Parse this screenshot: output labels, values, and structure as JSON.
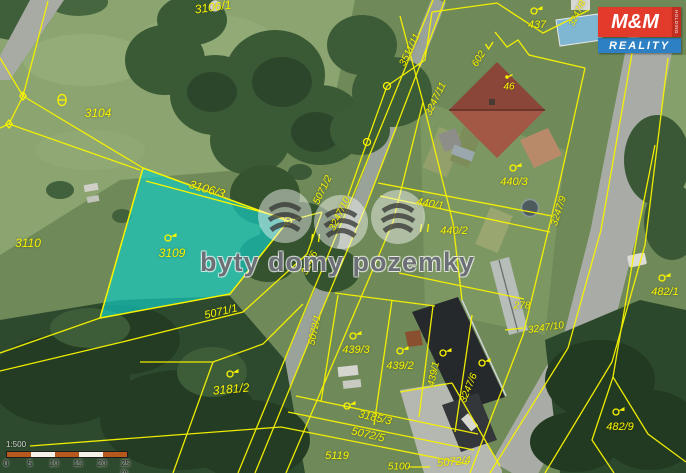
{
  "map": {
    "watermark_text": "byty domy pozemky",
    "logo": {
      "line1": "M&M",
      "line2": "REALITY",
      "side": "HOLDING",
      "red": "#e23b2c",
      "blue": "#2e80c4"
    },
    "scalebar": {
      "ratio": "1:500",
      "ticks": [
        "0",
        "5",
        "10",
        "15",
        "20",
        "25 m"
      ],
      "segment_colors": [
        "#b5591d",
        "#f5f2ea",
        "#b5591d",
        "#f5f2ea",
        "#b5591d"
      ]
    },
    "highlight": {
      "parcel": "3109",
      "fill": "#13cdc4",
      "line_color": "#f8f400"
    },
    "parcel_labels": [
      {
        "text": "3106/1",
        "x": 213,
        "y": 7,
        "rot": -8,
        "size": 12
      },
      {
        "text": "3104",
        "x": 98,
        "y": 113,
        "rot": 0,
        "size": 12
      },
      {
        "text": "3110",
        "x": 28,
        "y": 243,
        "rot": 0,
        "size": 12
      },
      {
        "text": "3106/3",
        "x": 207,
        "y": 189,
        "rot": 16,
        "size": 12
      },
      {
        "text": "3109",
        "x": 172,
        "y": 253,
        "rot": 0,
        "size": 12
      },
      {
        "text": "5071/1",
        "x": 221,
        "y": 312,
        "rot": -13,
        "size": 11
      },
      {
        "text": "3181/2",
        "x": 231,
        "y": 389,
        "rot": -5,
        "size": 12
      },
      {
        "text": "5071/2",
        "x": 323,
        "y": 190,
        "rot": -64,
        "size": 10
      },
      {
        "text": "3247/10",
        "x": 340,
        "y": 214,
        "rot": -64,
        "size": 10
      },
      {
        "text": "324/6",
        "x": 310,
        "y": 263,
        "rot": -64,
        "size": 10
      },
      {
        "text": "5072/1",
        "x": 315,
        "y": 330,
        "rot": -78,
        "size": 10
      },
      {
        "text": "3511/11",
        "x": 410,
        "y": 50,
        "rot": -64,
        "size": 10
      },
      {
        "text": "3247/11",
        "x": 436,
        "y": 99,
        "rot": -64,
        "size": 10
      },
      {
        "text": "602",
        "x": 479,
        "y": 59,
        "rot": -58,
        "size": 10
      },
      {
        "text": "437",
        "x": 537,
        "y": 25,
        "rot": 0,
        "size": 11
      },
      {
        "text": "46",
        "x": 509,
        "y": 87,
        "rot": 0,
        "size": 10
      },
      {
        "text": "3247/8",
        "x": 577,
        "y": 13,
        "rot": -64,
        "size": 9
      },
      {
        "text": "440/1",
        "x": 430,
        "y": 204,
        "rot": 10,
        "size": 11
      },
      {
        "text": "440/2",
        "x": 454,
        "y": 231,
        "rot": 0,
        "size": 11
      },
      {
        "text": "440/3",
        "x": 514,
        "y": 182,
        "rot": 0,
        "size": 11
      },
      {
        "text": "3247/9",
        "x": 559,
        "y": 211,
        "rot": -72,
        "size": 10
      },
      {
        "text": "278",
        "x": 522,
        "y": 306,
        "rot": 0,
        "size": 10
      },
      {
        "text": "3247/10",
        "x": 546,
        "y": 328,
        "rot": -8,
        "size": 10
      },
      {
        "text": "482/1",
        "x": 665,
        "y": 292,
        "rot": 0,
        "size": 11
      },
      {
        "text": "482/9",
        "x": 620,
        "y": 427,
        "rot": 0,
        "size": 11
      },
      {
        "text": "439/3",
        "x": 356,
        "y": 350,
        "rot": 0,
        "size": 11
      },
      {
        "text": "439/2",
        "x": 400,
        "y": 366,
        "rot": 0,
        "size": 11
      },
      {
        "text": "439/1",
        "x": 434,
        "y": 374,
        "rot": -78,
        "size": 10
      },
      {
        "text": "3247/6",
        "x": 469,
        "y": 388,
        "rot": -68,
        "size": 10
      },
      {
        "text": "3185/3",
        "x": 375,
        "y": 418,
        "rot": 13,
        "size": 11
      },
      {
        "text": "5072/5",
        "x": 368,
        "y": 435,
        "rot": 13,
        "size": 11
      },
      {
        "text": "5119",
        "x": 337,
        "y": 456,
        "rot": 0,
        "size": 11
      },
      {
        "text": "5100",
        "x": 399,
        "y": 467,
        "rot": 0,
        "size": 10
      },
      {
        "text": "5072/4",
        "x": 454,
        "y": 462,
        "rot": -5,
        "size": 11
      }
    ],
    "symbols": [
      {
        "type": "theta",
        "x": 62,
        "y": 100
      },
      {
        "type": "flag",
        "x": 168,
        "y": 238
      },
      {
        "type": "flag",
        "x": 230,
        "y": 374
      },
      {
        "type": "flag",
        "x": 353,
        "y": 336
      },
      {
        "type": "flag",
        "x": 400,
        "y": 351
      },
      {
        "type": "flag",
        "x": 443,
        "y": 353
      },
      {
        "type": "flag",
        "x": 482,
        "y": 363
      },
      {
        "type": "flag",
        "x": 513,
        "y": 168
      },
      {
        "type": "flag",
        "x": 534,
        "y": 11
      },
      {
        "type": "flag",
        "x": 662,
        "y": 278
      },
      {
        "type": "flag",
        "x": 616,
        "y": 412
      },
      {
        "type": "flag",
        "x": 347,
        "y": 406
      },
      {
        "type": "grass",
        "x": 316,
        "y": 238
      },
      {
        "type": "grass",
        "x": 425,
        "y": 228
      },
      {
        "type": "check",
        "x": 489,
        "y": 46
      },
      {
        "type": "dot",
        "x": 507,
        "y": 77
      },
      {
        "type": "vertex-circle",
        "x": 288,
        "y": 221
      },
      {
        "type": "vertex-circle",
        "x": 387,
        "y": 86
      },
      {
        "type": "vertex-circle",
        "x": 367,
        "y": 142
      },
      {
        "type": "vertex-diamond",
        "x": 23,
        "y": 96
      },
      {
        "type": "vertex-diamond",
        "x": 9,
        "y": 124
      }
    ]
  }
}
